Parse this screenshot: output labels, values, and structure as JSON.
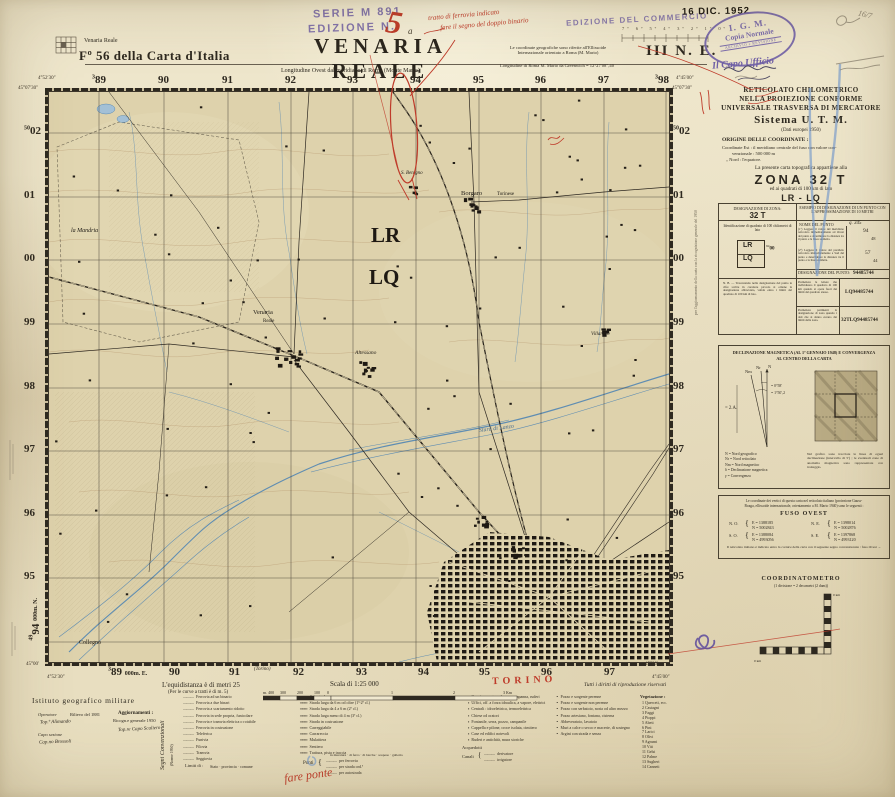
{
  "header": {
    "index_label": "Venaria Reale",
    "sheet_ref": "Fº 56 della Carta d'Italia",
    "series_stamp": "SERIE M 891",
    "edition_stamp": "EDIZIONE N.",
    "edition_number_handwritten": "5",
    "title": "VENARIA REALE",
    "title_annotation": "a",
    "longitude_note": "Longitudine Ovest dal meridiano di Roma (Monte Mario)",
    "coord_note": "Le coordinate geografiche sono riferite all'Ellissoide Internazionale orientato a Roma (M. Mario)",
    "greenwich_note": "Longitudine di Roma M. Mario da Greenwich = 12°27′08″,40",
    "quadrant": "III N. E.",
    "commerce_stamp": "EDIZIONE DEL COMMERCIO",
    "date_stamp": "16 DIC. 1952",
    "igm_stamp": {
      "line1": "I. G. M.",
      "line2": "Copia Normale",
      "line3": "ARCHIVIO e REVISIONE"
    },
    "capo_ufficio": "Il Capo Ufficio",
    "red_note_1": "tratto di ferrovia indicato",
    "red_note_2": "fare il segno del doppio binario",
    "pencil_note": "16/7",
    "ruler_degrees": "7º 6º 5º 4º 3º 2º 1º 0º"
  },
  "map": {
    "grid_top_prefix": "3",
    "grid_top": [
      "89",
      "90",
      "91",
      "92",
      "93",
      "94",
      "95",
      "96",
      "97",
      "98"
    ],
    "grid_left_prefix": "50",
    "grid_left": [
      "02",
      "01",
      "00",
      "99",
      "98",
      "97",
      "96",
      "95"
    ],
    "grid_bottom": [
      "89",
      "90",
      "91",
      "92",
      "93",
      "94",
      "95",
      "96",
      "97"
    ],
    "grid_bottom_suffix": "000m. E.",
    "grid_bl_prefix": "49",
    "grid_bl_num": "94",
    "grid_bl_suffix": "000m. N.",
    "corner_tl_lat": "45°07′30″",
    "corner_tl_lon": "4°52′30″",
    "corner_tr_lat": "45°07′30″",
    "corner_tr_lon": "4°45′00″",
    "corner_bl_lat": "45°00′",
    "corner_bl_lon": "4°52′30″",
    "corner_br_lat": "45°00′",
    "corner_br_lon": "4°45′00″",
    "square_lr": "LR",
    "square_lq": "LQ",
    "labels": {
      "mandria": "la Mandria",
      "venaria1": "Venaria",
      "venaria2": "Reale",
      "altessano": "Altessano",
      "sbenigno": "S. Benigno",
      "borgaro": "Borgaro",
      "borgaro2": "Torinese",
      "villaretto": "Villaretto",
      "collegno": "Collegno",
      "stura": "Stura di Lanzo"
    },
    "direction_label": "(Torino)",
    "torino_margin": "TORINO",
    "margin_note_right": "per l'aggiornamento della carta con la ricognizione generale del 1950"
  },
  "right_panel": {
    "reticolato1": "RETICOLATO CHILOMETRICO",
    "reticolato2": "NELLA PROIEZIONE CONFORME",
    "reticolato3": "UNIVERSALE TRASVERSA DI MERCATORE",
    "sistema": "Sistema U. T. M.",
    "dati": "(Dati europei 1950)",
    "origine_title": "ORIGINE DELLE COORDINATE :",
    "origine_1": "Coordinate Est : il meridiano centrale del fuso con valore con-",
    "origine_2": "venzionale : 500 000 m",
    "origine_3": "„   Nord : l'equatore.",
    "appartiene": "La presente carta topografica appartiene alla",
    "zona": "ZONA 32 T",
    "quadrati": "ed ai quadrati di 100 km di lato",
    "squares": "LR - LQ",
    "table": {
      "zona_header": "DESIGNAZIONE DI ZONA:",
      "zona_value": "32 T",
      "esempio_header": "ESEMPIO DI DESIGNAZIONE DI UN PUNTO CON L'APPROSSIMAZIONE DI 10 METRI",
      "ident_note": "Identificazione di quadrato di 100 chilometri di lato",
      "sq1": "LR",
      "sq2": "LQ",
      "sq_num_prefix": "94",
      "sq_num": "00",
      "nome_punto": "NOME DEL PUNTO",
      "nome_punto_value": "q. 345",
      "instr1": "(1º) Leggere il valore del meridiano reticolato immediatamente ad Ovest del punto e determinare la distanza tra il punto e la linea suddetta.",
      "instr2": "(2º) Leggere il valore del parallelo reticolato immediatamente a Sud del punto e determinare la distanza tra il punto e la linea suddetta.",
      "n1": "94",
      "n2": "48",
      "n3": "57",
      "n4": "44",
      "desig_header": "DESIGNAZIONE DEL PUNTO:",
      "desig1": "94485744",
      "instr3": "Premettere le lettere che individuano il quadrato di 100 km quando si opera fuori dei limiti del quadrato stesso.",
      "desig2": "LQ94485744",
      "instr4": "Premettere parimenti la designazione di zona quando i dati che si danno escano dai limiti della zona.",
      "desig3": "32TLQ94485744",
      "nb": "N. B. — Trascurando nella designazione del punto le cifre scritte in carattere piccolo si ottiene la designazione abbreviata, valida entro i limiti del quadrato di 100 km di lato."
    },
    "declinazione": {
      "title1": "DECLINAZIONE MAGNETICA (AL 1º GENNAIO 1948) E CONVERGENZA",
      "title2": "AL CENTRO DELLA CARTA",
      "arrow_n": "N",
      "arrow_nr": "Nr",
      "arrow_nm": "Nm",
      "val_left": "= 2.A.",
      "val_1": "= 0°58′",
      "val_2": "= 1°50′,2",
      "legend1": "N   =  Nord geografico",
      "legend2": "Nr  =  Nord reticolato",
      "legend3": "Nm =  Nord magnetico",
      "legend4": "δ   =  Declinazione magnetica",
      "legend5": "γ   =  Convergenza",
      "note": "Nel grafico sono tracciate le linee di egual declinazione (intervallo di 5′) ; le eventuali zone di anomalia magnetica sono rappresentate con tratteggio."
    },
    "fuso": {
      "intro1": "Le coordinate dei vertici di questa carta nel reticolato italiano (proiezione Gauss-",
      "intro2": "Boaga, ellissoide internazionale, orientamento a M. Mario 1940) sono le seguenti :",
      "title": "FUSO OVEST",
      "no_label": "N. O.",
      "no_e": "E = 1388185",
      "no_n": "N = 5002843",
      "ne_label": "N. E.",
      "ne_e": "E = 1398014",
      "ne_n": "N = 5002876",
      "so_label": "S. O.",
      "so_e": "E = 1388084",
      "so_n": "N = 4993056",
      "se_label": "S. E.",
      "se_e": "E = 1397868",
      "se_n": "N = 4993120",
      "outro": "Il reticolato italiano è indicato entro la cornice della carta con il seguente segno convenzionale :  fuso Ovest →"
    },
    "coordinatometro": {
      "title": "COORDINATOMETRO",
      "subtitle": "(1 divisione = 2 decametri (2 dam))",
      "km_top": "0 km",
      "km_left": "0 km"
    }
  },
  "footer": {
    "equidistanza": "L'equidistanza è di metri 25",
    "equidistanza2": "(Per le curve a tratti è di m. 5)",
    "istituto": "Istituto geografico militare",
    "operatore_label": "Operatore",
    "operatore": "Top.º Alimando",
    "rilievo": "Rilievo del 1881",
    "capo_label": "Capo sezione",
    "capo": "Cap.no Brossoli",
    "aggiornamenti_label": "Aggiornamenti :",
    "aggiornamenti1": "Ricogn.e generale 1950",
    "aggiornamenti2": "Top.re Capo Scaliero",
    "segni": "Segni Convenzionali",
    "segni_sub": "(Norme 1950)",
    "scala": "Scala di 1:25 000",
    "scale_ticks": [
      "m. 400",
      "300",
      "200",
      "100",
      "0",
      "1",
      "2",
      "3 Km"
    ],
    "rights": "Tutti i diritti di riproduzione riservati",
    "legend_col1": [
      "Ferrovia ad un binario",
      "Ferrovia a due binari",
      "Ferrovia a scartamento ridotto",
      "Ferrovia in sede propria, funicolare",
      "Ferrovia e tramvia elettrica o rotabile",
      "Ferrovia in costruzione",
      "Teleferica",
      "Funivia",
      "Filovia",
      "Tramvia",
      "Seggiovia"
    ],
    "limiti_label": "Limiti di :",
    "limiti_values": "Stato · provincia · comune",
    "legend_col2": [
      "Autostrada",
      "Strada larga da 6 m od oltre (1ª-2ª cl.)",
      "Strada larga da 4 a 6 m (2ª cl.)",
      "Strada larga meno di 4 m (3ª cl.)",
      "Strada in costruzione",
      "Carreggiabile",
      "Carrareccia",
      "Mulattiera",
      "Sentiero",
      "Trattura, pista e traccia"
    ],
    "ponti_label": "Ponti",
    "ponti_types_line": "in muratura · di ferro · di barche · sospeso · galleria",
    "ponti_items": [
      "per ferrovia",
      "per strada ord.ª",
      "per autostrada"
    ],
    "acquedotti": "Acquedotti",
    "canali_label": "Canali",
    "canali_items": [
      "derivatore",
      "irrigatore"
    ],
    "legend_col3": [
      "Case in muratura, baracca, capanna, ruderi",
      "Uffici, off. a forza idraulica, a vapore, elettrici",
      "Centrali : idroelettrica, termoelettrica",
      "Chiese od oratori",
      "Fontanile, serra, pozzo, campanile",
      "Cappella e pilone, croce isolata, cimitero",
      "Case ed edifici notevoli",
      "Ruderi e antichità, mura storiche"
    ],
    "legend_col4": [
      "Pozzo e sorgente perenne",
      "Pozzo e sorgente non perenne",
      "Pozzo con serbatoio, noria od altro mezzo",
      "Pozzo artesiano, fontana, cisterna",
      "Abbeveratoio, lavatoio",
      "Muri a calce o secco e macerie, di sostegno",
      "Argini con strada e senza"
    ],
    "vegetazione_label": "Vegetazione :",
    "vegetazione": [
      "1  Querceti, ecc.",
      "2  Castagni",
      "3  Faggi",
      "4  Pioppi",
      "5  Abeti",
      "6  Pini",
      "7  Larici",
      "8  Olivi",
      "9  Agrumi",
      "10 Viti",
      "11 Gelsi",
      "12 Palme",
      "13 Sugheri",
      "14 Canneti"
    ],
    "red_note_bottom": "fare ponte"
  }
}
